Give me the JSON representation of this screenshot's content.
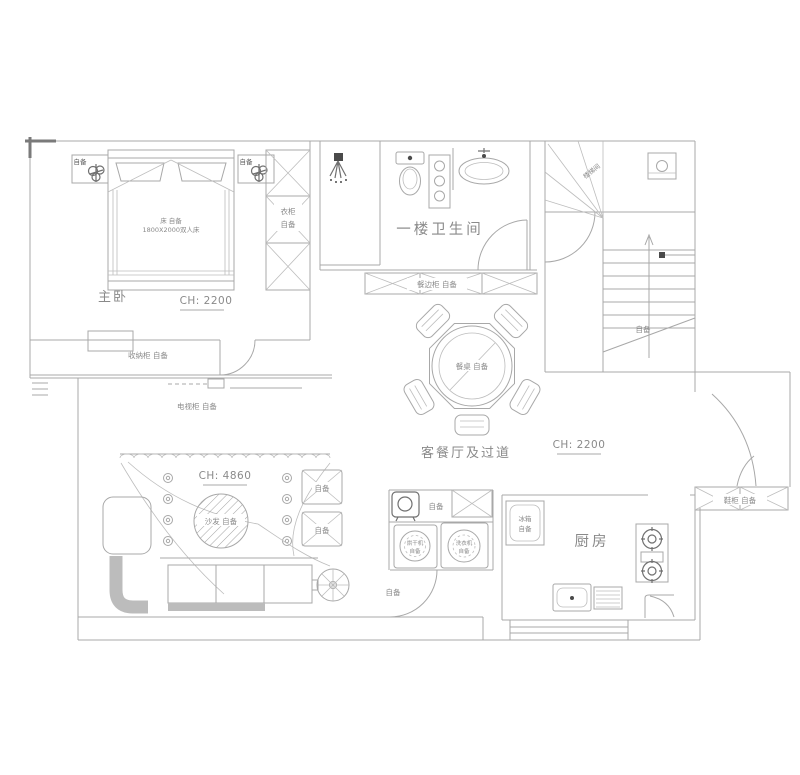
{
  "drawing_type": "residential first-floor plan",
  "colors": {
    "background": "#ffffff",
    "line": "#a8a8a8",
    "text": "#8a8a8a",
    "dark_accent": "#4a4a4a",
    "gray_fill": "#bcbcbc"
  },
  "rooms": {
    "master_bedroom": {
      "name": "主卧",
      "ceiling": "CH: 2200"
    },
    "bathroom": {
      "name": "一楼卫生间"
    },
    "living_dining": {
      "name": "客餐厅及过道",
      "ceiling": "CH: 2200"
    },
    "living_ceiling": {
      "ceiling": "CH: 4860"
    },
    "kitchen": {
      "name": "厨房"
    },
    "stairwell": {
      "name": "楼梯间"
    }
  },
  "annotations": {
    "bed_line1": "床 自备",
    "bed_line2": "1800X2000双人床",
    "plant_left": "自备",
    "plant_right": "自备",
    "wardrobe_line1": "衣柜",
    "wardrobe_line2": "自备",
    "storage_cabinet": "收纳柜 自备",
    "tv_cabinet": "电视柜 自备",
    "sideboard": "餐边柜 自备",
    "dining_table": "餐桌 自备",
    "sofa": "沙发 自备",
    "stool_top": "自备",
    "stool_bottom": "自备",
    "passage_note": "自备",
    "water_heater": "自备",
    "dryer_line1": "烘干机",
    "dryer_line2": "自备",
    "washer_line1": "洗衣机",
    "washer_line2": "自备",
    "fridge_line1": "冰箱",
    "fridge_line2": "自备",
    "shoe_cabinet": "鞋柜 自备",
    "stair_note": "自备"
  }
}
